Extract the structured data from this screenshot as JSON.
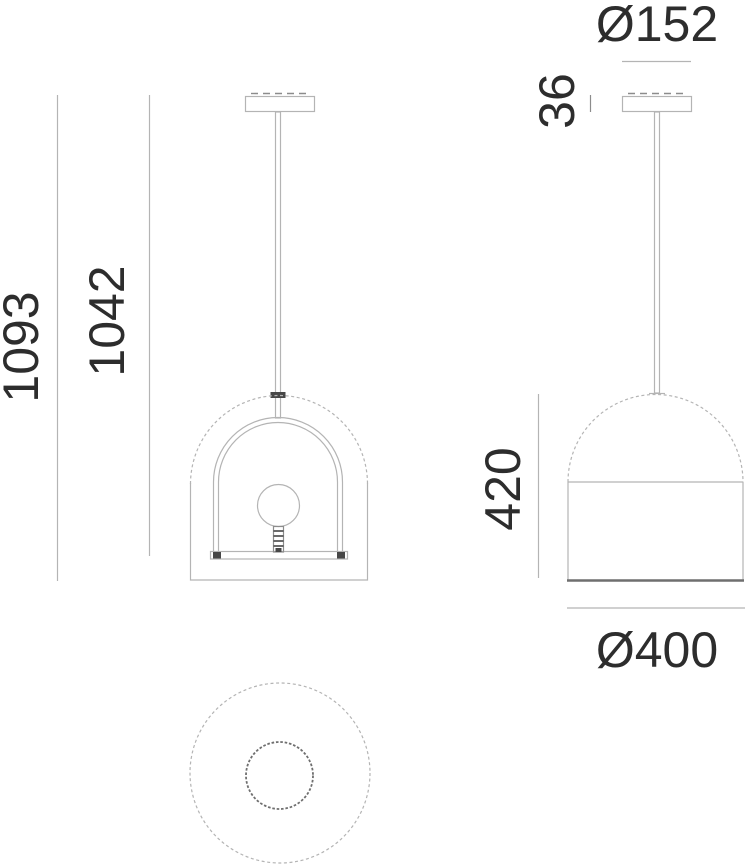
{
  "title": "Pendant lamp technical dimension drawing",
  "labels": {
    "overall_height": "1093",
    "frame_height": "1042",
    "canopy_diameter": "Ø152",
    "canopy_height": "36",
    "shade_height": "420",
    "shade_diameter": "Ø400"
  },
  "colors": {
    "line_light": "#b4b4b4",
    "line_medium": "#8c8c8c",
    "line_strong": "#6f6f6f",
    "line_dark": "#474747",
    "text": "#2d2d2d",
    "background": "#ffffff"
  }
}
